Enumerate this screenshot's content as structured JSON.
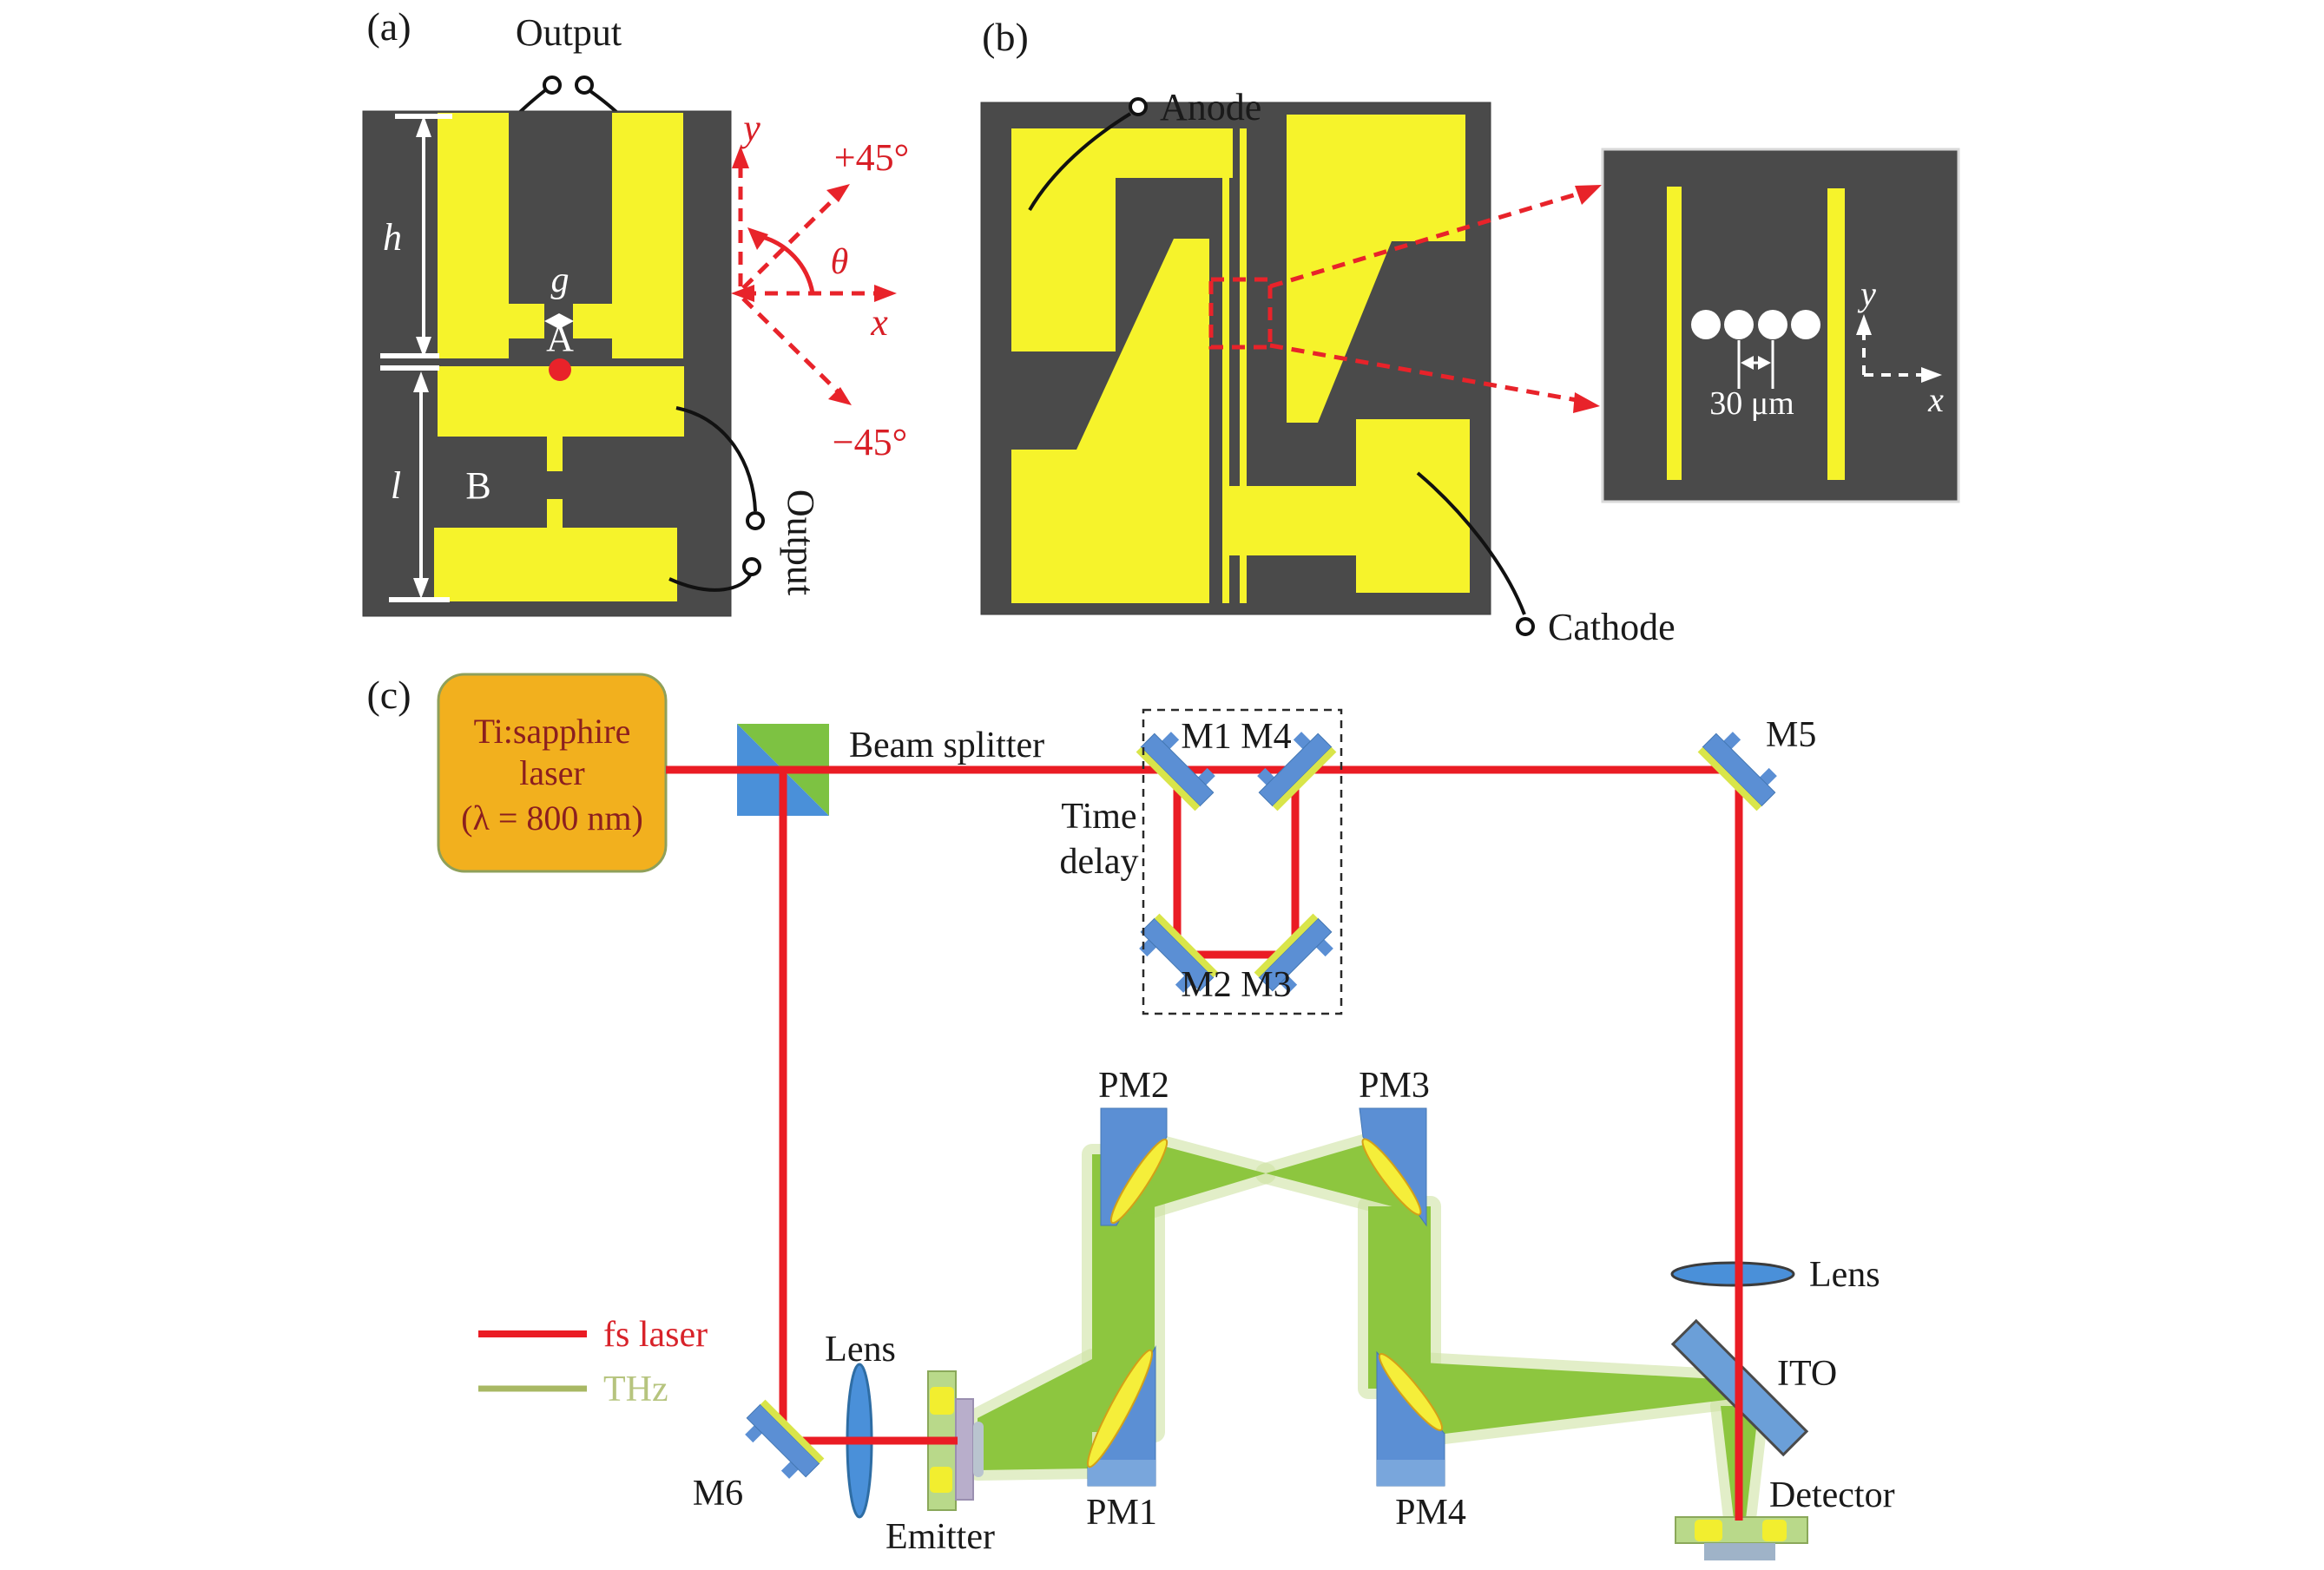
{
  "figure": {
    "type": "scientific-figure",
    "description": "Photoconductive THz antenna geometry and fs-laser THz time-domain spectroscopy setup"
  },
  "colors": {
    "panel_bg": "#4a4a4a",
    "electrode_yellow": "#f6f32b",
    "accent_red": "#e8232a",
    "mirror_blue": "#5b8fd4",
    "mirror_stripe": "#d9e54a",
    "pm_mirror_yellow": "#f5ee3a",
    "thz_green": "#8dc63f",
    "thz_halo": "#cfe3a4",
    "laser_box": "#f2b01e",
    "laser_text": "#8b1f1f",
    "bs_green": "#7dc242",
    "bs_blue": "#4a90d9"
  },
  "panel_a": {
    "tag": "(a)",
    "output_top": "Output",
    "output_bottom": "Output",
    "label_h": "h",
    "label_g": "g",
    "label_l": "l",
    "label_A": "A",
    "label_B": "B",
    "axis": {
      "y": "y",
      "x": "x",
      "plus45": "+45°",
      "minus45": "−45°",
      "theta": "θ"
    }
  },
  "panel_b": {
    "tag": "(b)",
    "anode": "Anode",
    "cathode": "Cathode",
    "inset": {
      "dimension": "30 μm",
      "axis_x": "x",
      "axis_y": "y"
    }
  },
  "panel_c": {
    "tag": "(c)",
    "laser_line1": "Ti:sapphire",
    "laser_line2": "laser",
    "laser_line3": "(λ = 800 nm)",
    "beam_splitter": "Beam splitter",
    "time_delay_line1": "Time",
    "time_delay_line2": "delay",
    "m1m4": "M1 M4",
    "m2m3": "M2 M3",
    "m5": "M5",
    "m6": "M6",
    "pm1": "PM1",
    "pm2": "PM2",
    "pm3": "PM3",
    "pm4": "PM4",
    "lens_emitter": "Lens",
    "lens_detector": "Lens",
    "emitter": "Emitter",
    "ito": "ITO",
    "detector": "Detector",
    "legend": {
      "fs_laser": "fs laser",
      "thz": "THz"
    }
  }
}
